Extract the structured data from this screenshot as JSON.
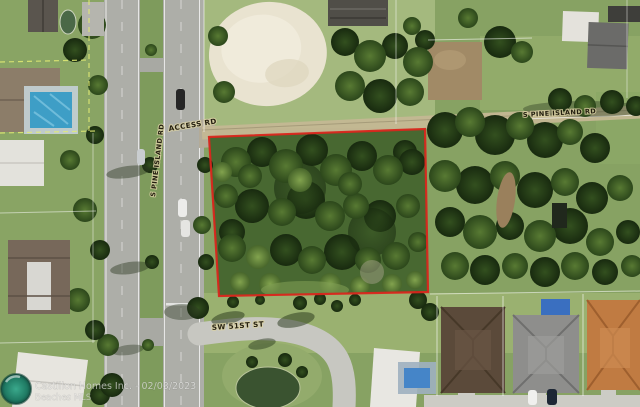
{
  "image_type": "aerial-satellite-listing-photo",
  "map_labels": {
    "access_road": "ACCESS RD",
    "pine_island_road_right": "S PINE ISLAND RD",
    "pine_island_road_median": "S PINE ISLAND RD",
    "sw_51st_street": "SW 51ST ST"
  },
  "watermark": {
    "brokerage_line": "Castillon Homes Inc. - 02/03/2023",
    "mls_line": "Beaches MLS"
  },
  "parcel_outline": {
    "color": "#d9261c",
    "points": "209,137 425,129 428,292 219,296"
  },
  "palette": {
    "outline_red": "#d9261c",
    "label_ink": "#241f10",
    "asphalt": "#adaea8",
    "concrete": "#c7c7c1",
    "grass": "#87a263",
    "tree_dark": "#1f3516",
    "sand": "#e9e3d0",
    "pool_blue": "#3e9ec6",
    "watermark_teal": "#2a8f76"
  }
}
